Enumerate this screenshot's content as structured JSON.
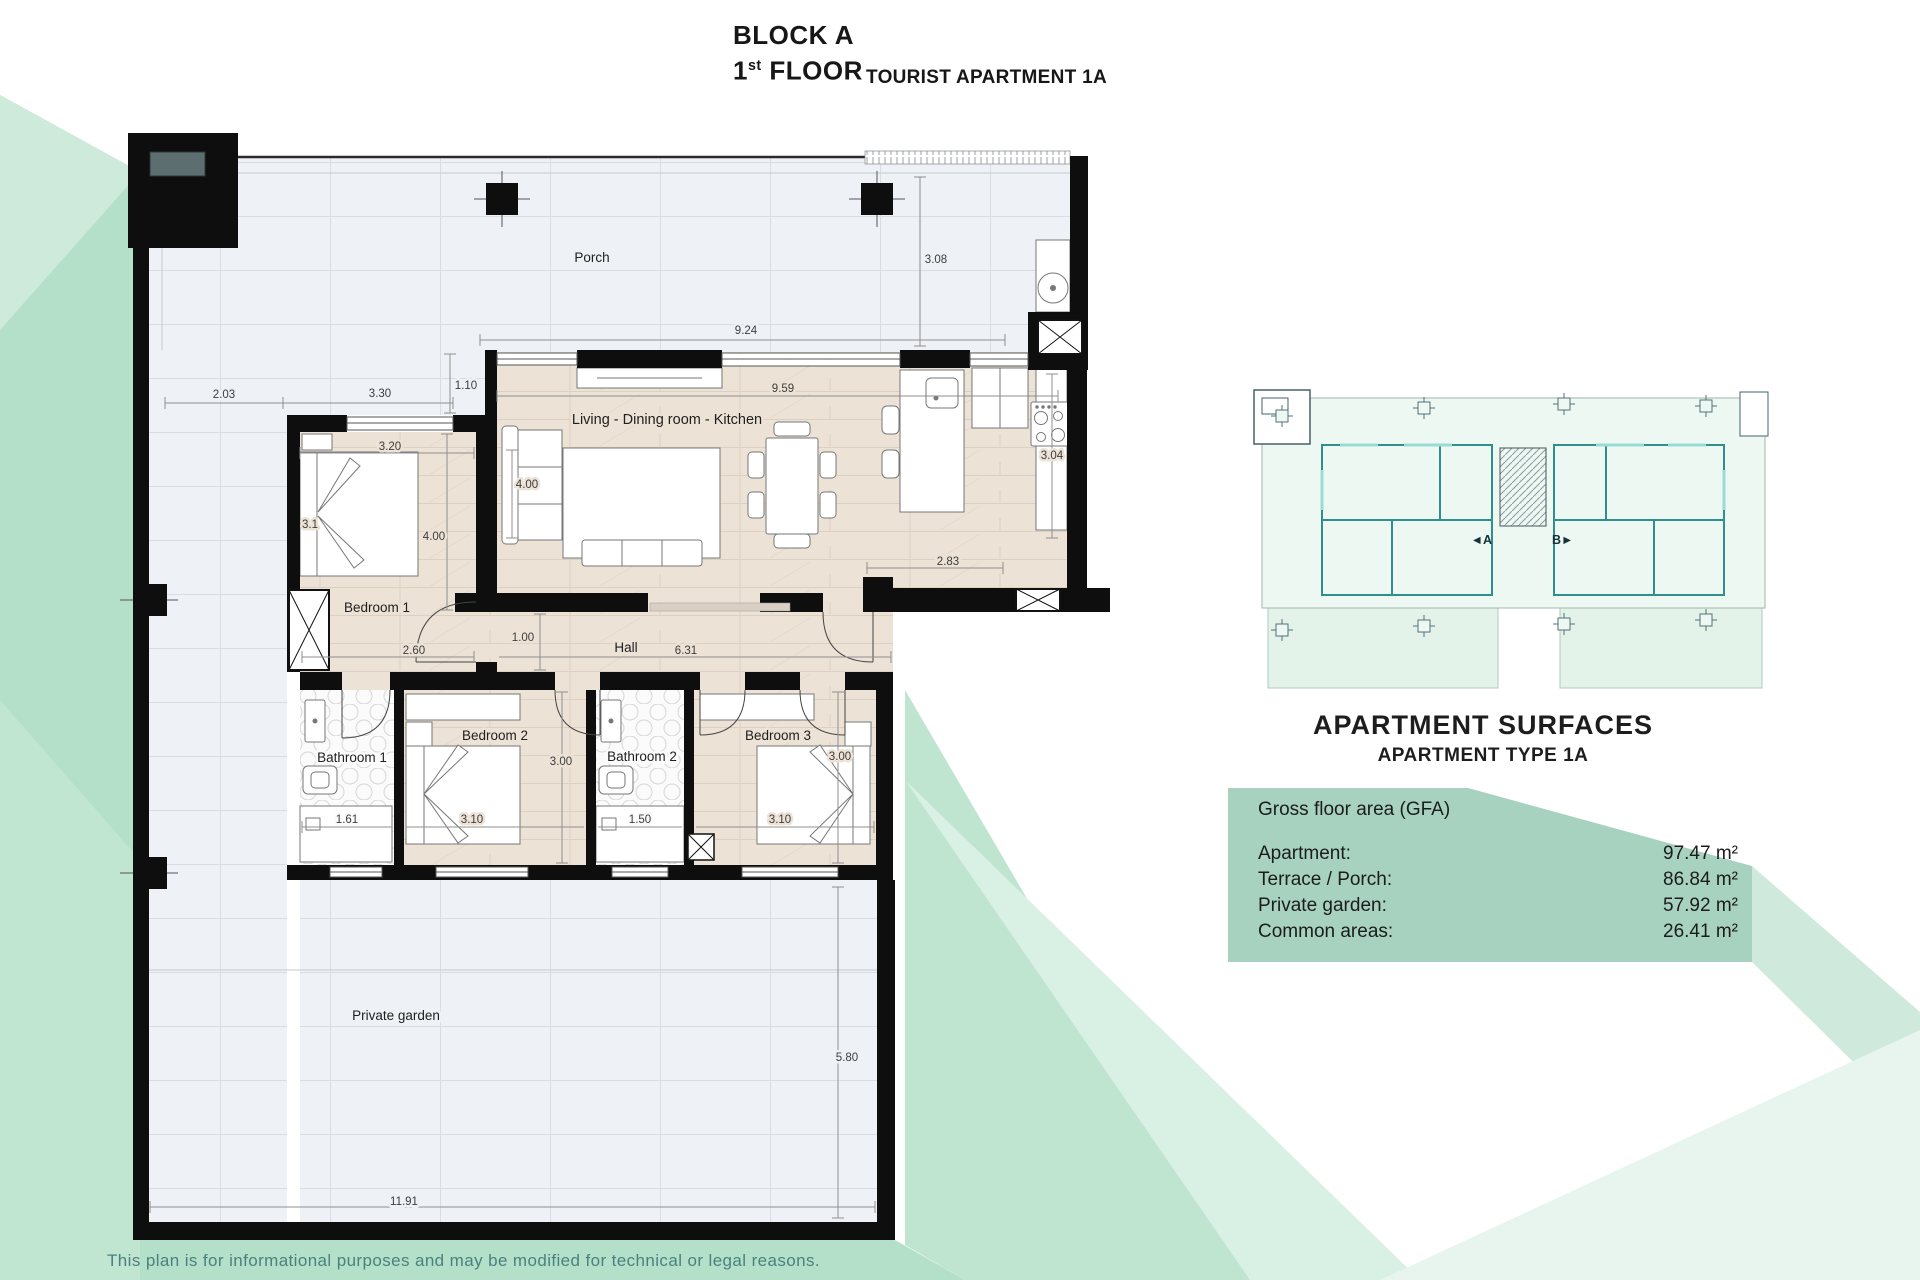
{
  "title": {
    "block": "BLOCK A",
    "floor_number": "1",
    "floor_ordinal": "st",
    "floor_word": " FLOOR",
    "subtitle": "TOURIST APARTMENT 1A"
  },
  "plan": {
    "rooms": [
      {
        "label": "Porch"
      },
      {
        "label": "Living - Dining room - Kitchen"
      },
      {
        "label": "Bedroom 1"
      },
      {
        "label": "Hall"
      },
      {
        "label": "Bathroom 1"
      },
      {
        "label": "Bedroom 2"
      },
      {
        "label": "Bathroom 2"
      },
      {
        "label": "Bedroom 3"
      },
      {
        "label": "Private garden"
      }
    ],
    "dimensions": [
      {
        "text": "2.03"
      },
      {
        "text": "3.30"
      },
      {
        "text": "1.10"
      },
      {
        "text": "9.24"
      },
      {
        "text": "9.59"
      },
      {
        "text": "3.08"
      },
      {
        "text": "3.20"
      },
      {
        "text": "4.00"
      },
      {
        "text": "3.1"
      },
      {
        "text": "4.00"
      },
      {
        "text": "3.04"
      },
      {
        "text": "2.83"
      },
      {
        "text": "1.00"
      },
      {
        "text": "2.60"
      },
      {
        "text": "6.31"
      },
      {
        "text": "3.00"
      },
      {
        "text": "3.00"
      },
      {
        "text": "1.61"
      },
      {
        "text": "3.10"
      },
      {
        "text": "1.50"
      },
      {
        "text": "3.10"
      },
      {
        "text": "5.80"
      },
      {
        "text": "11.91"
      }
    ]
  },
  "overview": {
    "unit_a": "◄A",
    "unit_b": "B►"
  },
  "surfaces": {
    "heading": "APARTMENT SURFACES",
    "subheading": "APARTMENT TYPE 1A",
    "section": "Gross floor area (GFA)",
    "rows": [
      {
        "label": "Apartment:",
        "value": "97.47 m²"
      },
      {
        "label": "Terrace / Porch:",
        "value": "86.84 m²"
      },
      {
        "label": "Private garden:",
        "value": "57.92 m²"
      },
      {
        "label": "Common areas:",
        "value": "26.41 m²"
      }
    ]
  },
  "disclaimer": "This plan is for informational purposes and may be modified for technical or legal reasons."
}
